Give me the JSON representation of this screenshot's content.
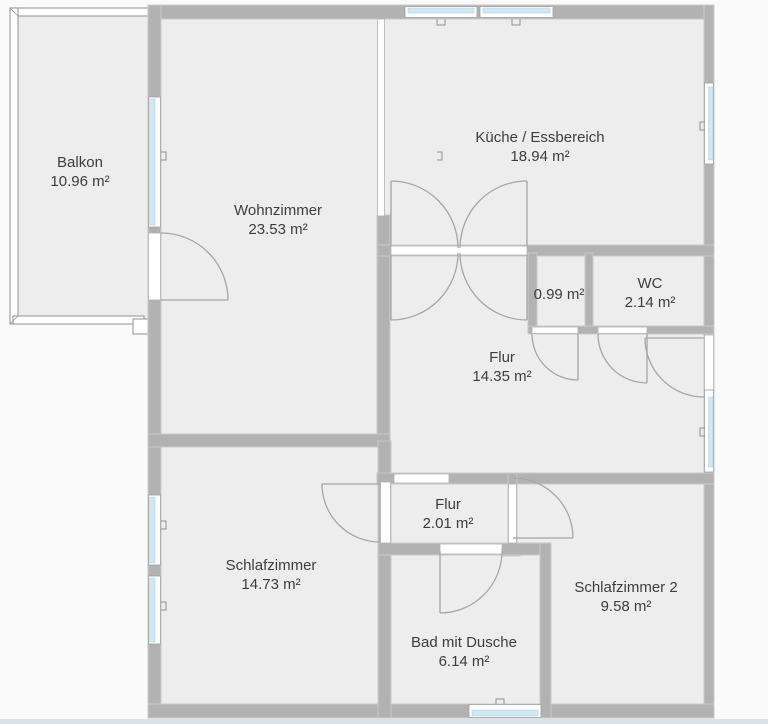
{
  "colors": {
    "wall": "#b2b2b2",
    "wall_edge": "#c9c9c9",
    "floor": "#ededed",
    "glass": "#cfe8f3",
    "background": "#fafafa",
    "line": "#a6a6a6",
    "footer": "#d7e3eb",
    "text": "#3d3d3d"
  },
  "rooms": [
    {
      "id": "balkon",
      "name": "Balkon",
      "area": "10.96 m²"
    },
    {
      "id": "wohnzimmer",
      "name": "Wohnzimmer",
      "area": "23.53 m²"
    },
    {
      "id": "kueche",
      "name": "Küche / Essbereich",
      "area": "18.94 m²"
    },
    {
      "id": "abstellraum",
      "name": "",
      "area": "0.99 m²"
    },
    {
      "id": "wc",
      "name": "WC",
      "area": "2.14 m²"
    },
    {
      "id": "flur",
      "name": "Flur",
      "area": "14.35 m²"
    },
    {
      "id": "flur2",
      "name": "Flur",
      "area": "2.01 m²"
    },
    {
      "id": "schlafzimmer",
      "name": "Schlafzimmer",
      "area": "14.73 m²"
    },
    {
      "id": "schlafzimmer2",
      "name": "Schlafzimmer 2",
      "area": "9.58 m²"
    },
    {
      "id": "bad",
      "name": "Bad mit Dusche",
      "area": "6.14 m²"
    }
  ]
}
